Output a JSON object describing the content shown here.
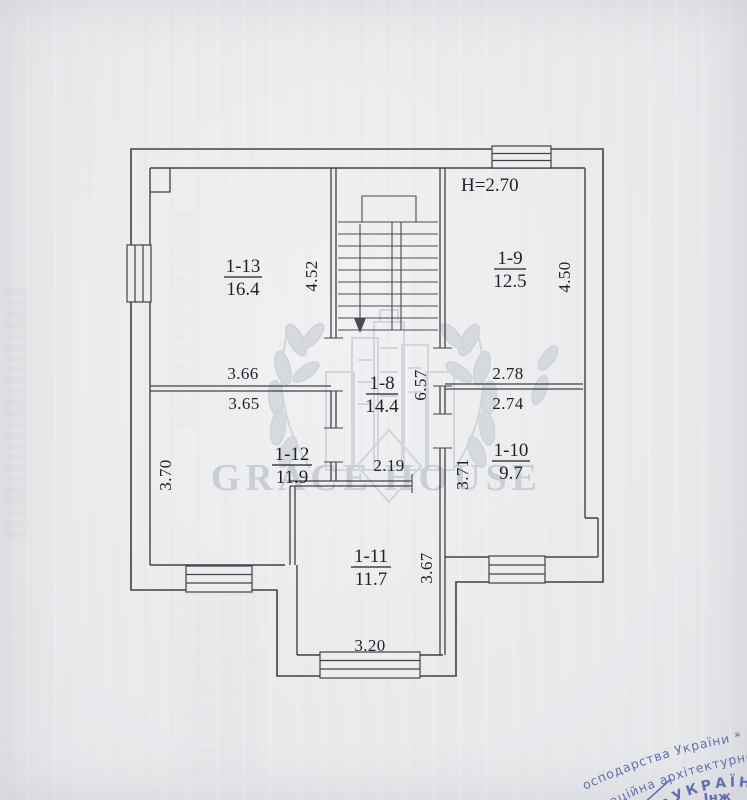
{
  "page": {
    "kind": "scanned-floor-plan",
    "plan": {
      "height_note": "H=2.70",
      "rooms": [
        {
          "id": "1-13",
          "area": "16.4"
        },
        {
          "id": "1-9",
          "area": "12.5"
        },
        {
          "id": "1-8",
          "area": "14.4"
        },
        {
          "id": "1-12",
          "area": "11.9"
        },
        {
          "id": "1-10",
          "area": "9.7"
        },
        {
          "id": "1-11",
          "area": "11.7"
        }
      ],
      "dimensions": {
        "r113_width": "3.66",
        "r113_height": "4.52",
        "r19_width": "2.78",
        "r19_height": "4.50",
        "r112_width": "3.65",
        "r112_height": "3.70",
        "r110_width": "2.74",
        "r110_height": "3.71",
        "hall_width": "2.19",
        "hall_height": "6.57",
        "r111_width": "3.20",
        "r111_height": "3.67"
      }
    },
    "watermark": {
      "word_left": "GRACE",
      "word_right": "HOUSE"
    },
    "stamp": {
      "arc_outer": "осподарства України * Мі",
      "arc_middle": "стаційна архітектурно-бу",
      "arc_country": "•УКРАЇНА•",
      "center_fragment": "Інж",
      "ink_color": "#4156a8"
    },
    "colors": {
      "paper": "#eaebed",
      "ink": "#3f4247",
      "text_ink": "#1f2227",
      "stamp_blue": "#4156a8",
      "watermark_gray": "#c7cbd3"
    }
  }
}
